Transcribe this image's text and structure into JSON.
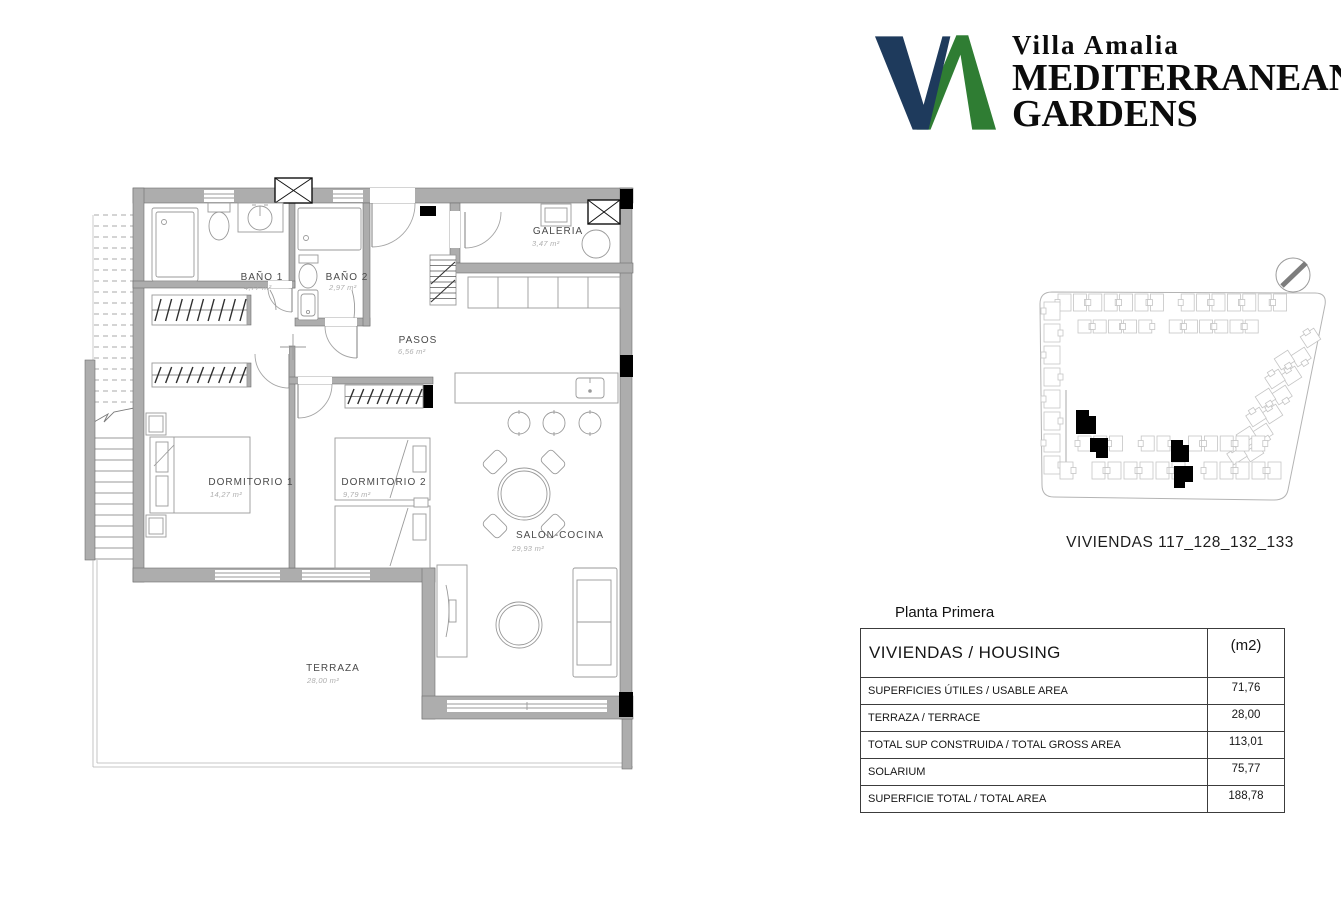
{
  "logo": {
    "script_line": "Villa Amalia",
    "title_line1": "MEDITERRANEAN",
    "title_line2": "GARDENS",
    "navy": "#1E3A5C",
    "green": "#2F7D33"
  },
  "floor_plan": {
    "rooms": [
      {
        "name": "BAÑO 1",
        "area": "4,77 m²"
      },
      {
        "name": "BAÑO 2",
        "area": "2,97 m²"
      },
      {
        "name": "GALERIA",
        "area": "3,47 m²"
      },
      {
        "name": "PASOS",
        "area": "6,56 m²"
      },
      {
        "name": "DORMITORIO 1",
        "area": "14,27 m²"
      },
      {
        "name": "DORMITORIO 2",
        "area": "9,79 m²"
      },
      {
        "name": "SALON-COCINA",
        "area": "29,93 m²"
      },
      {
        "name": "TERRAZA",
        "area": "28,00 m²"
      }
    ]
  },
  "site_plan": {
    "caption": "VIVIENDAS  117_128_132_133"
  },
  "summary": {
    "title": "Planta Primera",
    "header_label": "VIVIENDAS / HOUSING",
    "header_unit": "(m2)",
    "rows": [
      {
        "label": "SUPERFICIES ÚTILES / USABLE AREA",
        "value": "71,76"
      },
      {
        "label": "TERRAZA / TERRACE",
        "value": "28,00"
      },
      {
        "label": "TOTAL SUP CONSTRUIDA / TOTAL GROSS AREA",
        "value": "113,01"
      },
      {
        "label": "SOLARIUM",
        "value": "75,77"
      },
      {
        "label": "SUPERFICIE TOTAL / TOTAL AREA",
        "value": "188,78"
      }
    ]
  }
}
